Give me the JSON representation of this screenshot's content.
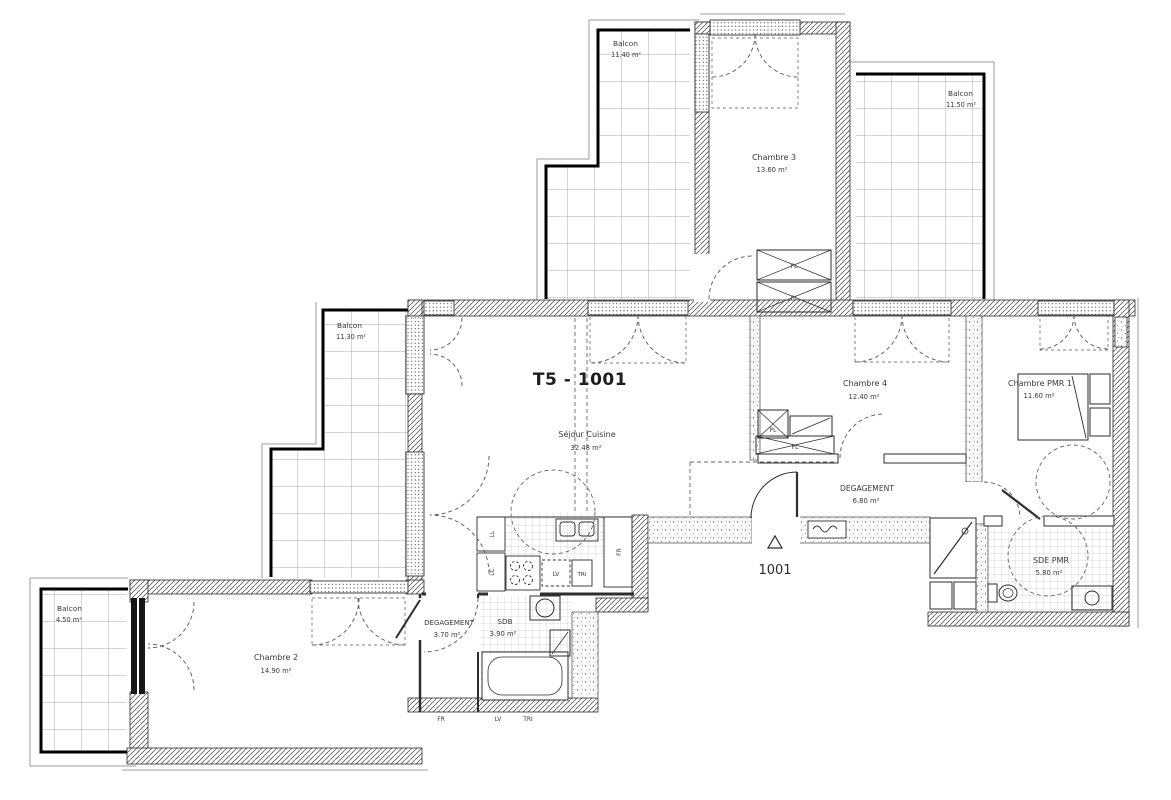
{
  "plan": {
    "title": "T5 - 1001",
    "unit_number": "1001",
    "rooms": [
      {
        "id": "balcon-top-left",
        "name": "Balcon",
        "area": "11.40 m²"
      },
      {
        "id": "chambre-3",
        "name": "Chambre 3",
        "area": "13.60 m²"
      },
      {
        "id": "balcon-top-right",
        "name": "Balcon",
        "area": "11.50 m²"
      },
      {
        "id": "balcon-left",
        "name": "Balcon",
        "area": "11.30 m²"
      },
      {
        "id": "sejour-cuisine",
        "name": "Séjour Cuisine",
        "area": "32.48 m²"
      },
      {
        "id": "chambre-4",
        "name": "Chambre 4",
        "area": "12.40 m²"
      },
      {
        "id": "chambre-pmr-1",
        "name": "Chambre PMR 1",
        "area": "11.60 m²"
      },
      {
        "id": "degagement-hall",
        "name": "DEGAGEMENT",
        "area": "6.80 m²"
      },
      {
        "id": "sde-pmr",
        "name": "SDE PMR",
        "area": "5.80 m²"
      },
      {
        "id": "balcon-bottom-left",
        "name": "Balcon",
        "area": "4.50 m²"
      },
      {
        "id": "chambre-2",
        "name": "Chambre 2",
        "area": "14.90 m²"
      },
      {
        "id": "degagement-2",
        "name": "DEGAGEMENT",
        "area": "3.70 m²"
      },
      {
        "id": "sdb",
        "name": "SDB",
        "area": "3.90 m²"
      }
    ],
    "closets": [
      "PL",
      "PL",
      "PL",
      "PL"
    ],
    "appliances": [
      "LL",
      "LC",
      "LV",
      "TRI",
      "FR"
    ],
    "legend": [
      "FR",
      "LV",
      "TRI"
    ],
    "colors": {
      "ink": "#2f2f2f",
      "paper": "#ffffff"
    }
  }
}
